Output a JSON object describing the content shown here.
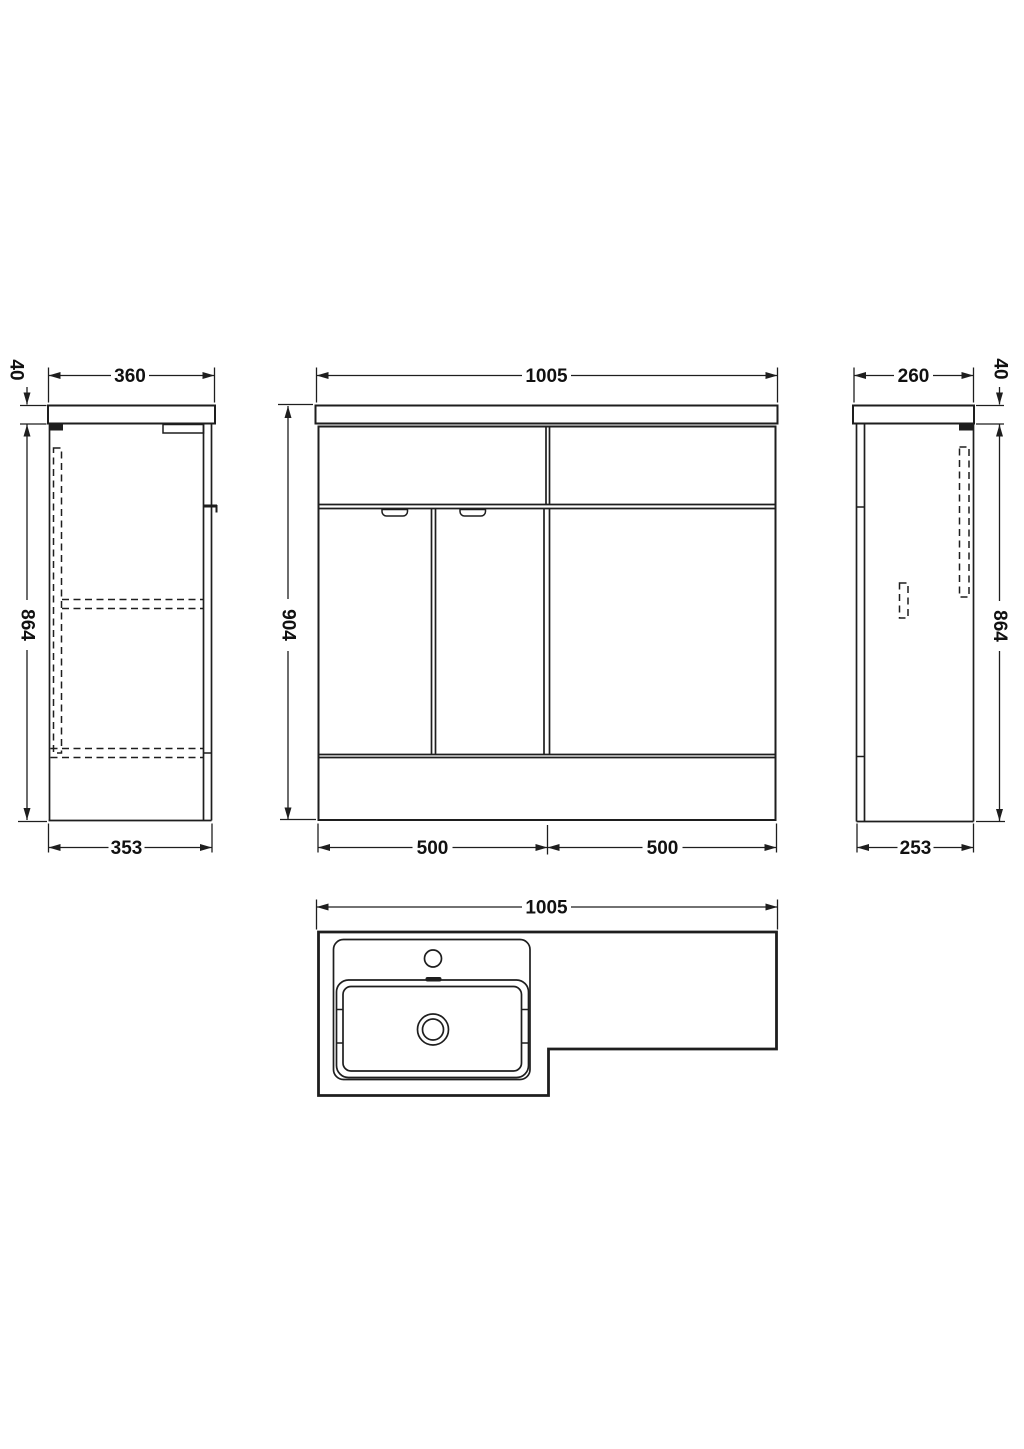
{
  "drawing": {
    "kind": "furniture-dimension-drawing",
    "line_color": "#1e1e1e",
    "background": "#ffffff"
  },
  "views": {
    "side_left": {
      "countertop_depth": "360",
      "countertop_thickness": "40",
      "cabinet_height": "864",
      "base_depth": "353"
    },
    "front": {
      "overall_width": "1005",
      "overall_height": "904",
      "left_section_width": "500",
      "right_section_width": "500"
    },
    "side_right": {
      "countertop_depth": "260",
      "countertop_thickness": "40",
      "cabinet_height": "864",
      "base_depth": "253"
    },
    "plan": {
      "overall_width": "1005"
    }
  }
}
